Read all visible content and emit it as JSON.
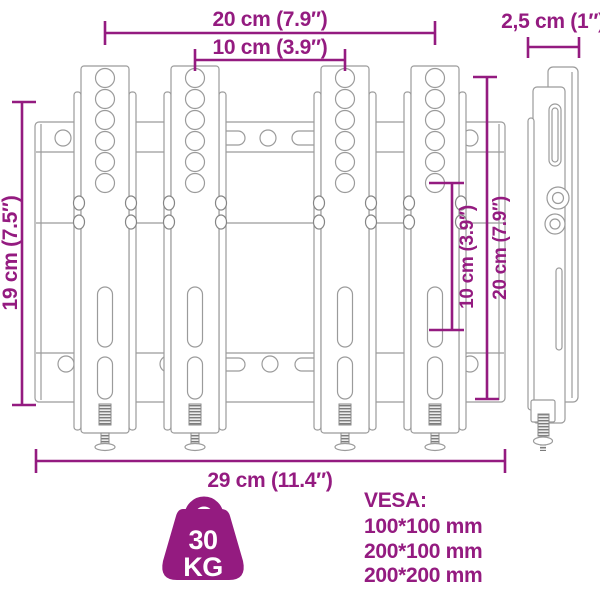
{
  "product": "tv-wall-mount-dimension-diagram",
  "colors": {
    "accent": "#941b80",
    "line_art": "#9b9b9b"
  },
  "dimensions": {
    "width_outer_holes": "20 cm (7.9″)",
    "width_inner_holes": "10 cm (3.9″)",
    "depth": "2,5 cm (1″)",
    "height_plate": "19 cm (7.5″)",
    "height_inner_holes": "10 cm (3.9″)",
    "height_outer_holes": "20 cm (7.9″)",
    "width_total": "29 cm (11.4″)"
  },
  "capacity_badge": {
    "value": "30",
    "unit": "KG"
  },
  "vesa": {
    "title": "VESA:",
    "sizes": [
      "100*100 mm",
      "200*100 mm",
      "200*200 mm"
    ]
  }
}
